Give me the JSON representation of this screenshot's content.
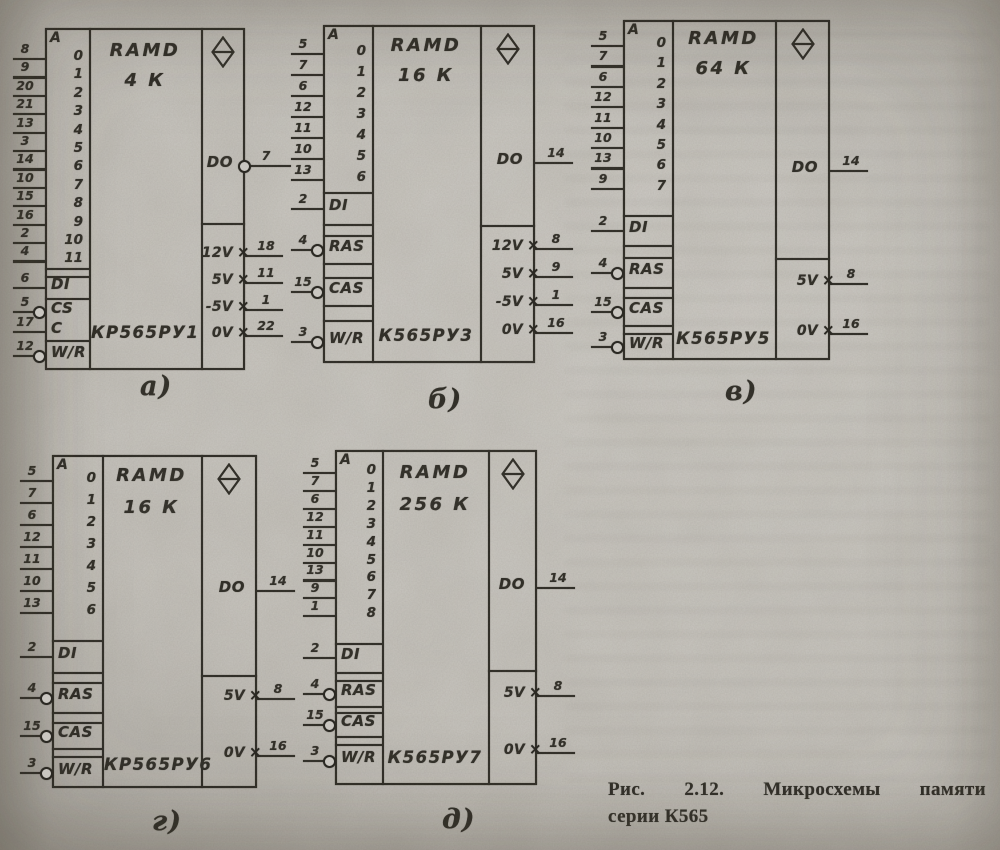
{
  "icons": {
    "non_logic_marker": "×"
  },
  "caption": {
    "line1": "Рис. 2.12. Микросхемы памяти",
    "line2": "серии К565"
  },
  "chips": [
    {
      "id": "a",
      "label": "а)",
      "block_type": "RAMD",
      "capacity": "4 К",
      "part": "КР565РУ1",
      "address_header": "A",
      "addresses": [
        {
          "bit": "0",
          "pin": "8"
        },
        {
          "bit": "1",
          "pin": "9"
        },
        {
          "bit": "2",
          "pin": "20"
        },
        {
          "bit": "3",
          "pin": "21"
        },
        {
          "bit": "4",
          "pin": "13"
        },
        {
          "bit": "5",
          "pin": "3"
        },
        {
          "bit": "6",
          "pin": "14"
        },
        {
          "bit": "7",
          "pin": "10"
        },
        {
          "bit": "8",
          "pin": "15"
        },
        {
          "bit": "9",
          "pin": "16"
        },
        {
          "bit": "10",
          "pin": "2"
        },
        {
          "bit": "11",
          "pin": "4"
        }
      ],
      "inputs": [
        {
          "label": "DI",
          "pin": "6",
          "inverted": false
        },
        {
          "label": "CS",
          "pin": "5",
          "inverted": true
        },
        {
          "label": "C",
          "pin": "17",
          "inverted": false
        },
        {
          "label": "W/R",
          "pin": "12",
          "inverted": true
        }
      ],
      "output": {
        "label": "DO",
        "pin": "7",
        "inverted": true
      },
      "power": [
        {
          "label": "12V",
          "pin": "18"
        },
        {
          "label": "5V",
          "pin": "11"
        },
        {
          "label": "-5V",
          "pin": "1"
        },
        {
          "label": "0V",
          "pin": "22"
        }
      ]
    },
    {
      "id": "b",
      "label": "б)",
      "block_type": "RAMD",
      "capacity": "16 К",
      "part": "К565РУ3",
      "address_header": "A",
      "addresses": [
        {
          "bit": "0",
          "pin": "5"
        },
        {
          "bit": "1",
          "pin": "7"
        },
        {
          "bit": "2",
          "pin": "6"
        },
        {
          "bit": "3",
          "pin": "12"
        },
        {
          "bit": "4",
          "pin": "11"
        },
        {
          "bit": "5",
          "pin": "10"
        },
        {
          "bit": "6",
          "pin": "13"
        }
      ],
      "inputs": [
        {
          "label": "DI",
          "pin": "2",
          "inverted": false
        },
        {
          "label": "RAS",
          "pin": "4",
          "inverted": true
        },
        {
          "label": "CAS",
          "pin": "15",
          "inverted": true
        },
        {
          "label": "W/R",
          "pin": "3",
          "inverted": true
        }
      ],
      "output": {
        "label": "DO",
        "pin": "14",
        "inverted": false
      },
      "power": [
        {
          "label": "12V",
          "pin": "8"
        },
        {
          "label": "5V",
          "pin": "9"
        },
        {
          "label": "-5V",
          "pin": "1"
        },
        {
          "label": "0V",
          "pin": "16"
        }
      ]
    },
    {
      "id": "v",
      "label": "в)",
      "block_type": "RAMD",
      "capacity": "64 К",
      "part": "К565РУ5",
      "address_header": "A",
      "addresses": [
        {
          "bit": "0",
          "pin": "5"
        },
        {
          "bit": "1",
          "pin": "7"
        },
        {
          "bit": "2",
          "pin": "6"
        },
        {
          "bit": "3",
          "pin": "12"
        },
        {
          "bit": "4",
          "pin": "11"
        },
        {
          "bit": "5",
          "pin": "10"
        },
        {
          "bit": "6",
          "pin": "13"
        },
        {
          "bit": "7",
          "pin": "9"
        }
      ],
      "inputs": [
        {
          "label": "DI",
          "pin": "2",
          "inverted": false
        },
        {
          "label": "RAS",
          "pin": "4",
          "inverted": true
        },
        {
          "label": "CAS",
          "pin": "15",
          "inverted": true
        },
        {
          "label": "W/R",
          "pin": "3",
          "inverted": true
        }
      ],
      "output": {
        "label": "DO",
        "pin": "14",
        "inverted": false
      },
      "power": [
        {
          "label": "5V",
          "pin": "8"
        },
        {
          "label": "0V",
          "pin": "16"
        }
      ]
    },
    {
      "id": "g",
      "label": "г)",
      "block_type": "RAMD",
      "capacity": "16 К",
      "part": "КР565РУ6",
      "address_header": "A",
      "addresses": [
        {
          "bit": "0",
          "pin": "5"
        },
        {
          "bit": "1",
          "pin": "7"
        },
        {
          "bit": "2",
          "pin": "6"
        },
        {
          "bit": "3",
          "pin": "12"
        },
        {
          "bit": "4",
          "pin": "11"
        },
        {
          "bit": "5",
          "pin": "10"
        },
        {
          "bit": "6",
          "pin": "13"
        }
      ],
      "inputs": [
        {
          "label": "DI",
          "pin": "2",
          "inverted": false
        },
        {
          "label": "RAS",
          "pin": "4",
          "inverted": true
        },
        {
          "label": "CAS",
          "pin": "15",
          "inverted": true
        },
        {
          "label": "W/R",
          "pin": "3",
          "inverted": true
        }
      ],
      "output": {
        "label": "DO",
        "pin": "14",
        "inverted": false
      },
      "power": [
        {
          "label": "5V",
          "pin": "8"
        },
        {
          "label": "0V",
          "pin": "16"
        }
      ]
    },
    {
      "id": "d",
      "label": "д)",
      "block_type": "RAMD",
      "capacity": "256 К",
      "part": "К565РУ7",
      "address_header": "A",
      "addresses": [
        {
          "bit": "0",
          "pin": "5"
        },
        {
          "bit": "1",
          "pin": "7"
        },
        {
          "bit": "2",
          "pin": "6"
        },
        {
          "bit": "3",
          "pin": "12"
        },
        {
          "bit": "4",
          "pin": "11"
        },
        {
          "bit": "5",
          "pin": "10"
        },
        {
          "bit": "6",
          "pin": "13"
        },
        {
          "bit": "7",
          "pin": "9"
        },
        {
          "bit": "8",
          "pin": "1"
        }
      ],
      "inputs": [
        {
          "label": "DI",
          "pin": "2",
          "inverted": false
        },
        {
          "label": "RAS",
          "pin": "4",
          "inverted": true
        },
        {
          "label": "CAS",
          "pin": "15",
          "inverted": true
        },
        {
          "label": "W/R",
          "pin": "3",
          "inverted": true
        }
      ],
      "output": {
        "label": "DO",
        "pin": "14",
        "inverted": false
      },
      "power": [
        {
          "label": "5V",
          "pin": "8"
        },
        {
          "label": "0V",
          "pin": "16"
        }
      ]
    }
  ]
}
